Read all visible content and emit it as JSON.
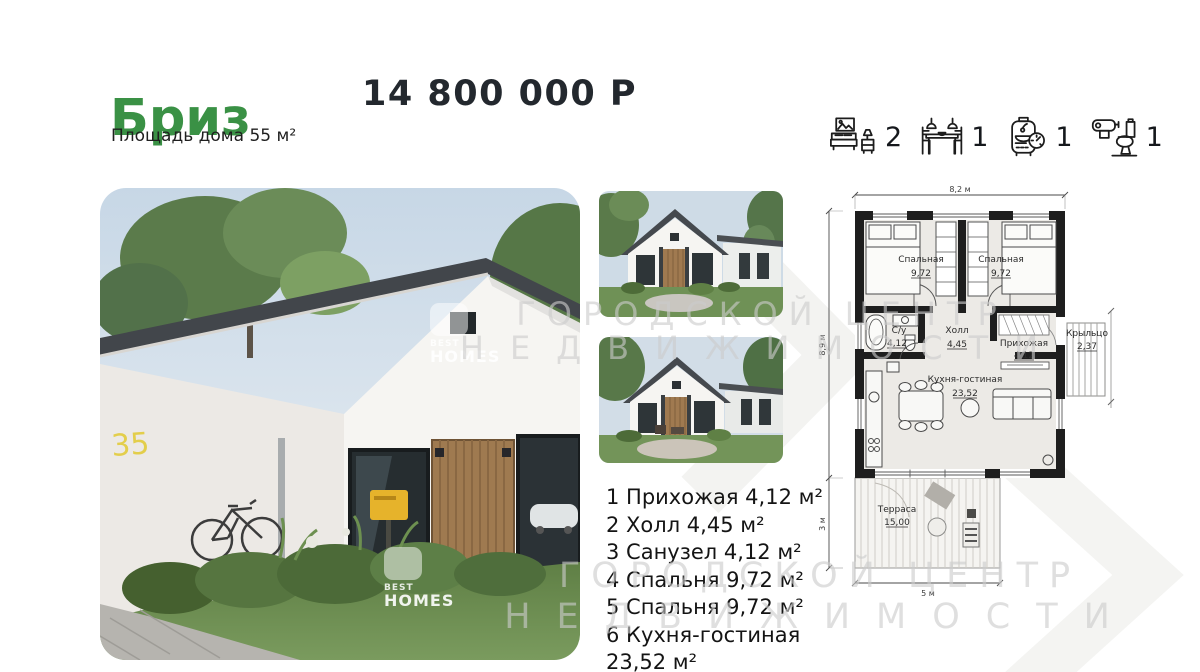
{
  "header": {
    "title": "Бриз",
    "area_label": "Площадь дома 55 м²",
    "price": "14 800 000 Р"
  },
  "features": [
    {
      "name": "bedrooms",
      "count": "2"
    },
    {
      "name": "dining",
      "count": "1"
    },
    {
      "name": "boiler",
      "count": "1"
    },
    {
      "name": "bathroom",
      "count": "1"
    }
  ],
  "photo": {
    "house_number": "35"
  },
  "watermarks": {
    "brand_line1": "BEST",
    "brand_line2": "HOMES",
    "center_line1": "ГОРОДСКОЙ ЦЕНТР",
    "center_line2": "НЕДВИЖИМОСТИ"
  },
  "room_list": {
    "lines": [
      "1 Прихожая 4,12 м²",
      "2 Холл 4,45 м²",
      "3 Санузел 4,12 м²",
      "4 Спальня 9,72 м²",
      "5 Спальня 9,72 м²",
      "6 Кухня-гостиная",
      "23,52 м²"
    ]
  },
  "floor_plan": {
    "dimensions": {
      "width_top": "8,2 м",
      "height_left": "8,9 м",
      "terrace_height": "3 м",
      "terrace_width": "5 м"
    },
    "rooms": [
      {
        "name": "Спальная",
        "area": "9,72"
      },
      {
        "name": "Спальная",
        "area": "9,72"
      },
      {
        "name": "С/у",
        "area": "4,12"
      },
      {
        "name": "Холл",
        "area": "4,45"
      },
      {
        "name": "Прихожая",
        "area": "4,12"
      },
      {
        "name": "Кухня-гостиная",
        "area": "23,52"
      },
      {
        "name": "Крыльцо",
        "area": "2,37"
      },
      {
        "name": "Терраса",
        "area": "15,00"
      }
    ]
  }
}
